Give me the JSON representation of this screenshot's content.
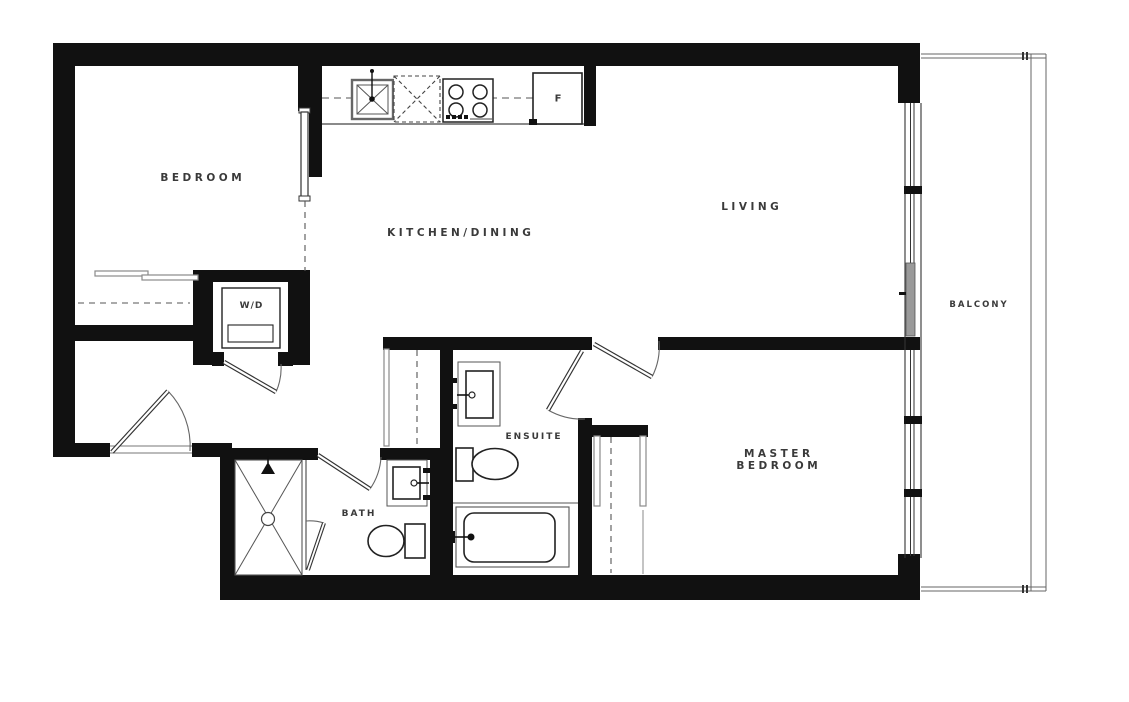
{
  "plan": {
    "title": "Two bedroom apartment floor plan",
    "rooms": {
      "bedroom": {
        "label": "BEDROOM"
      },
      "kitchen_dining": {
        "label": "KITCHEN/DINING"
      },
      "living": {
        "label": "LIVING"
      },
      "master_bedroom": {
        "label_line1": "MASTER",
        "label_line2": "BEDROOM"
      },
      "ensuite": {
        "label": "ENSUITE"
      },
      "bath": {
        "label": "BATH"
      },
      "balcony": {
        "label": "BALCONY"
      },
      "laundry_closet": {
        "label": "W/D"
      }
    },
    "appliances": {
      "fridge_label": "F"
    },
    "colors": {
      "wall": "#111111",
      "fixture_line": "#222222",
      "thin_line": "#555555",
      "light_line": "#8a8a8a",
      "label_text": "#3a3a3a",
      "glass_door": "#9a9a9a",
      "background": "#ffffff"
    }
  }
}
